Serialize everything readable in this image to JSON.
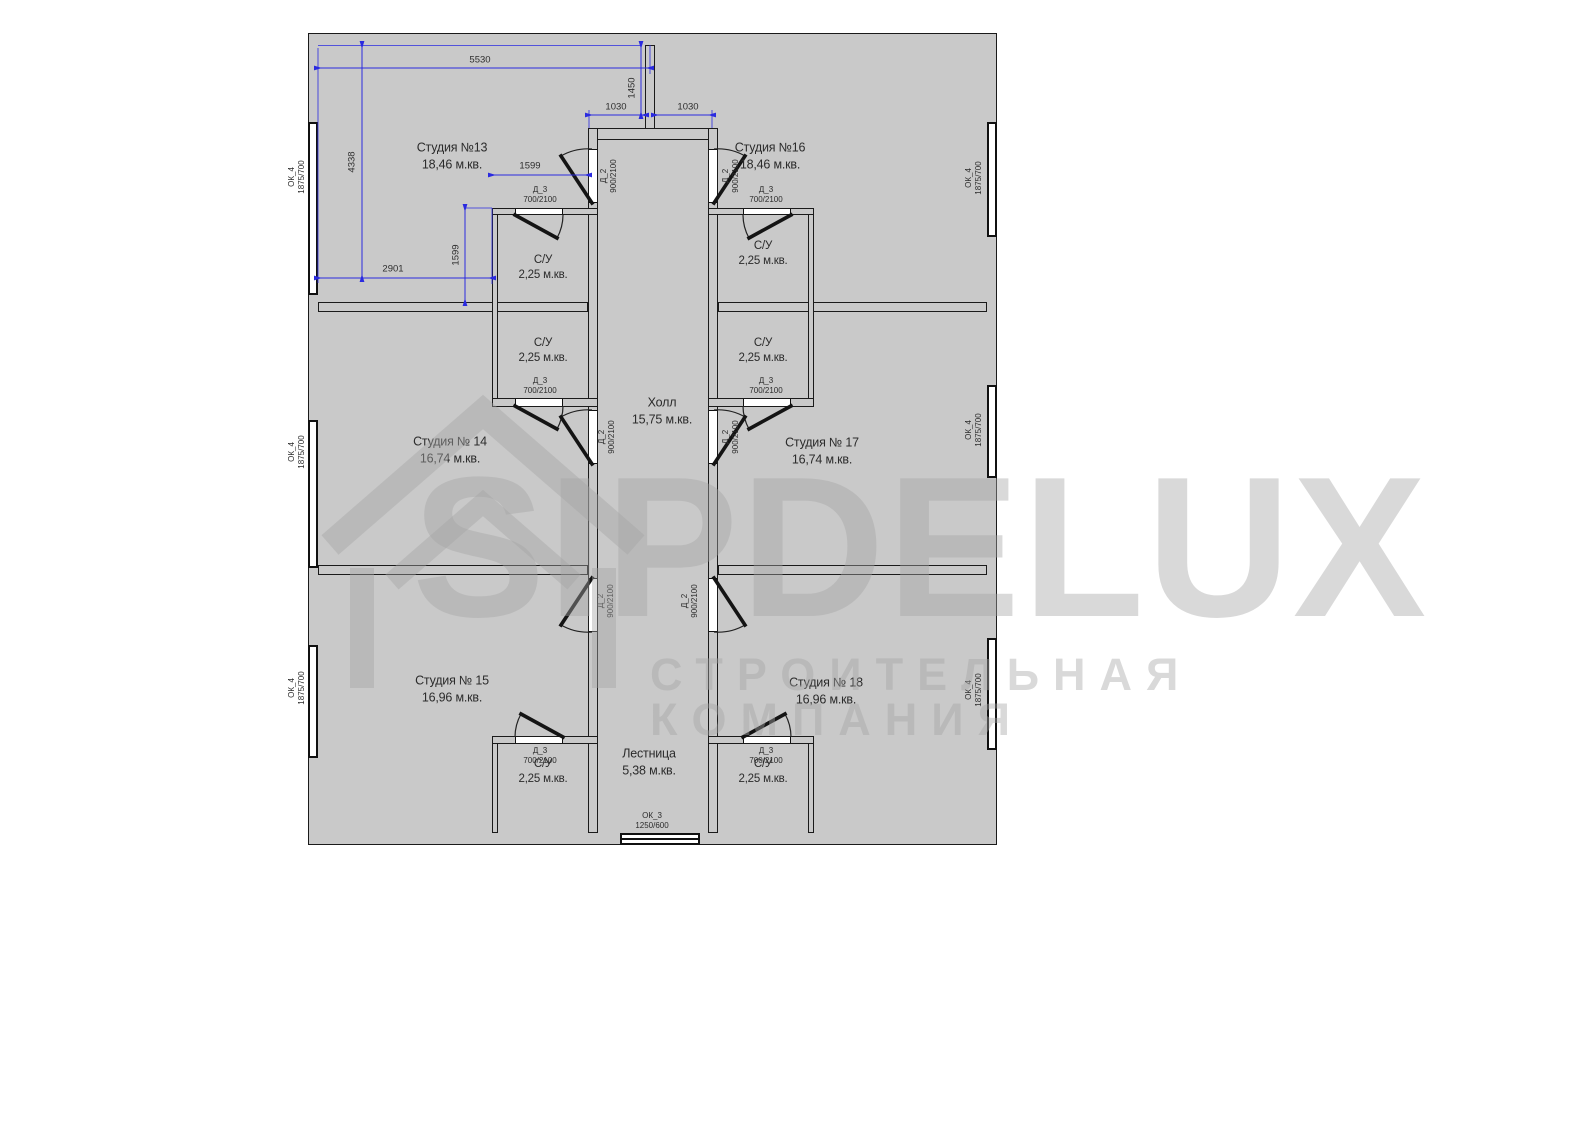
{
  "watermark": {
    "brand": "SIPDELUX",
    "tagline": "СТРОИТЕЛЬНАЯ КОМПАНИЯ"
  },
  "rooms": {
    "studio13": {
      "name": "Студия №13",
      "area": "18,46 м.кв."
    },
    "studio16": {
      "name": "Студия №16",
      "area": "18,46 м.кв."
    },
    "studio14": {
      "name": "Студия № 14",
      "area": "16,74 м.кв."
    },
    "studio17": {
      "name": "Студия № 17",
      "area": "16,74 м.кв."
    },
    "studio15": {
      "name": "Студия № 15",
      "area": "16,96 м.кв."
    },
    "studio18": {
      "name": "Студия № 18",
      "area": "16,96 м.кв."
    },
    "hall": {
      "name": "Холл",
      "area": "15,75 м.кв."
    },
    "stairs": {
      "name": "Лестница",
      "area": "5,38 м.кв."
    },
    "bathroom": {
      "name": "С/У",
      "area": "2,25 м.кв."
    }
  },
  "doors": {
    "d2": {
      "code": "Д_2",
      "size": "900/2100"
    },
    "d3": {
      "code": "Д_3",
      "size": "700/2100"
    }
  },
  "windows": {
    "ok4": {
      "code": "ОК_4",
      "size": "1875/700"
    },
    "ok3": {
      "code": "ОК_3",
      "size": "1250/600"
    }
  },
  "dimensions": {
    "top_width": "5530",
    "entry_offset": "1450",
    "hall_left": "1030",
    "hall_right": "1030",
    "left_height": "4338",
    "bath_width": "1599",
    "bath_height": "1599",
    "room_width": "2901"
  },
  "colors": {
    "room_pink": "#f5cdcd",
    "bath_blue": "#a6c7ef",
    "hall_gray": "#dcdcdc",
    "stairs_gray": "#d0d0d0",
    "wall_gray": "#c9c9c9",
    "dimension_blue": "#2a2ae0"
  }
}
